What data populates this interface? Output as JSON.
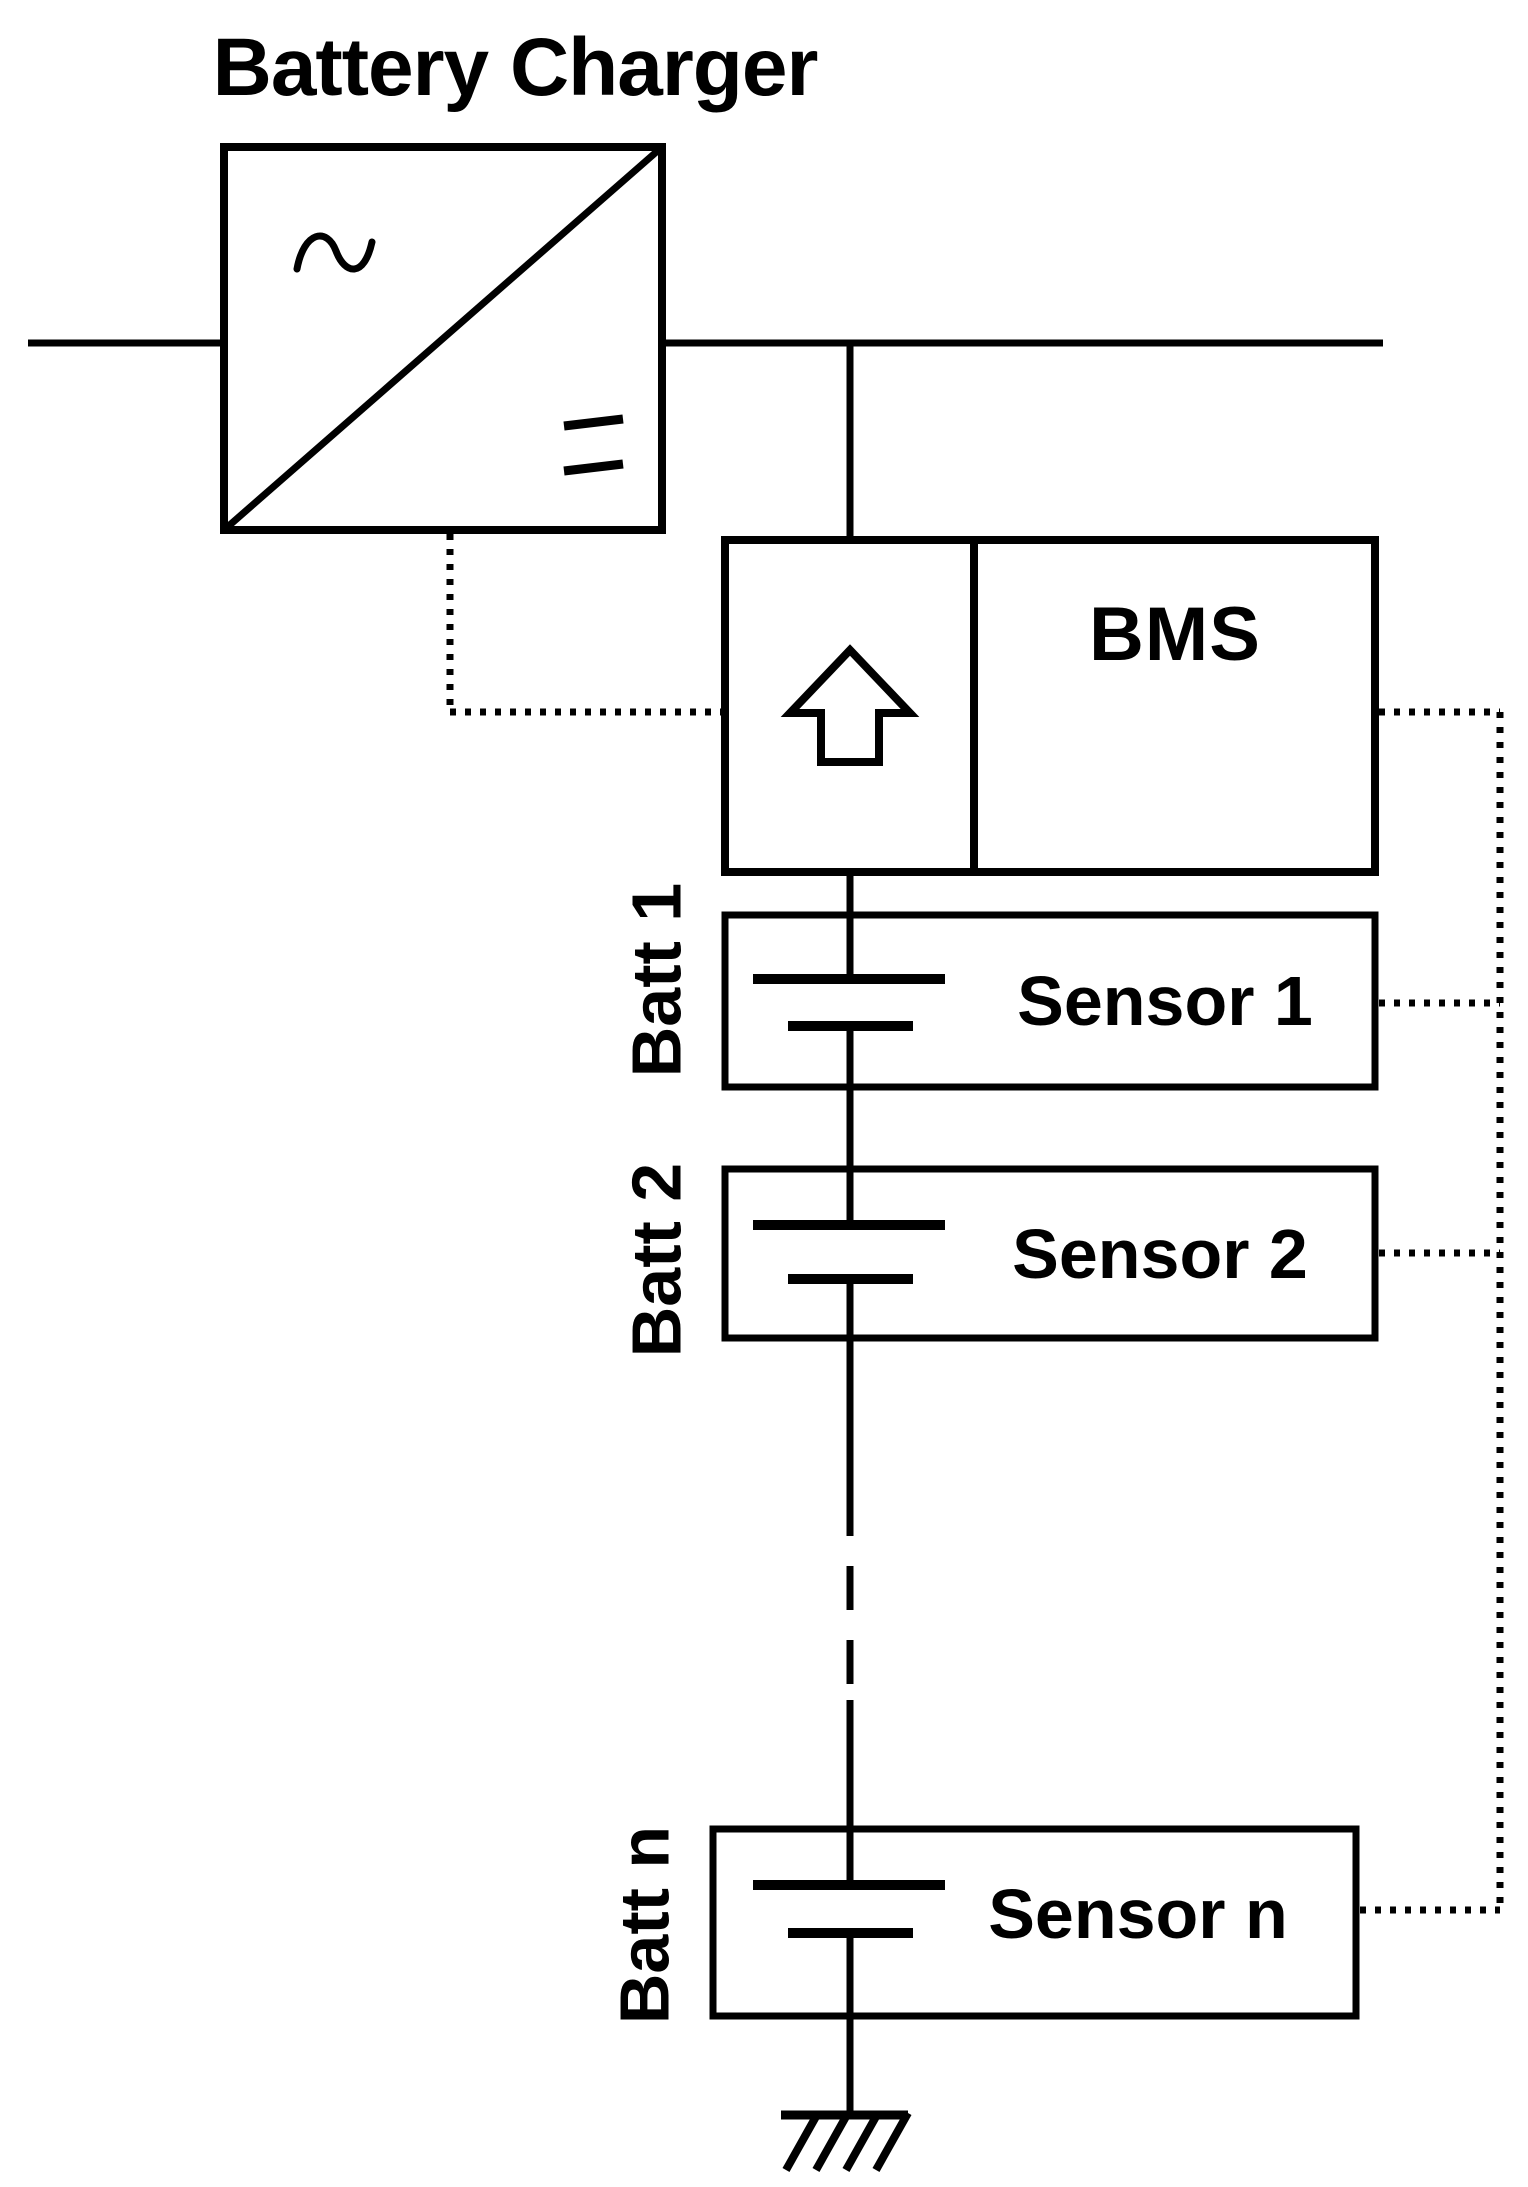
{
  "canvas": {
    "background_color": "#ffffff",
    "line_color": "#000000"
  },
  "charger": {
    "title": "Battery Charger",
    "ac_icon": "ac-sine-icon",
    "dc_icon": "dc-bars-icon",
    "converter_icon": "ac-dc-converter-box"
  },
  "bms": {
    "label": "BMS",
    "arrow_icon": "up-arrow-icon"
  },
  "strings": [
    {
      "battery_label": "Batt 1",
      "sensor_label": "Sensor 1",
      "battery_icon": "battery-cell-icon"
    },
    {
      "battery_label": "Batt 2",
      "sensor_label": "Sensor 2",
      "battery_icon": "battery-cell-icon"
    },
    {
      "battery_label": "Batt n",
      "sensor_label": "Sensor n",
      "battery_icon": "battery-cell-icon"
    }
  ],
  "ground": {
    "icon": "ground-icon"
  }
}
